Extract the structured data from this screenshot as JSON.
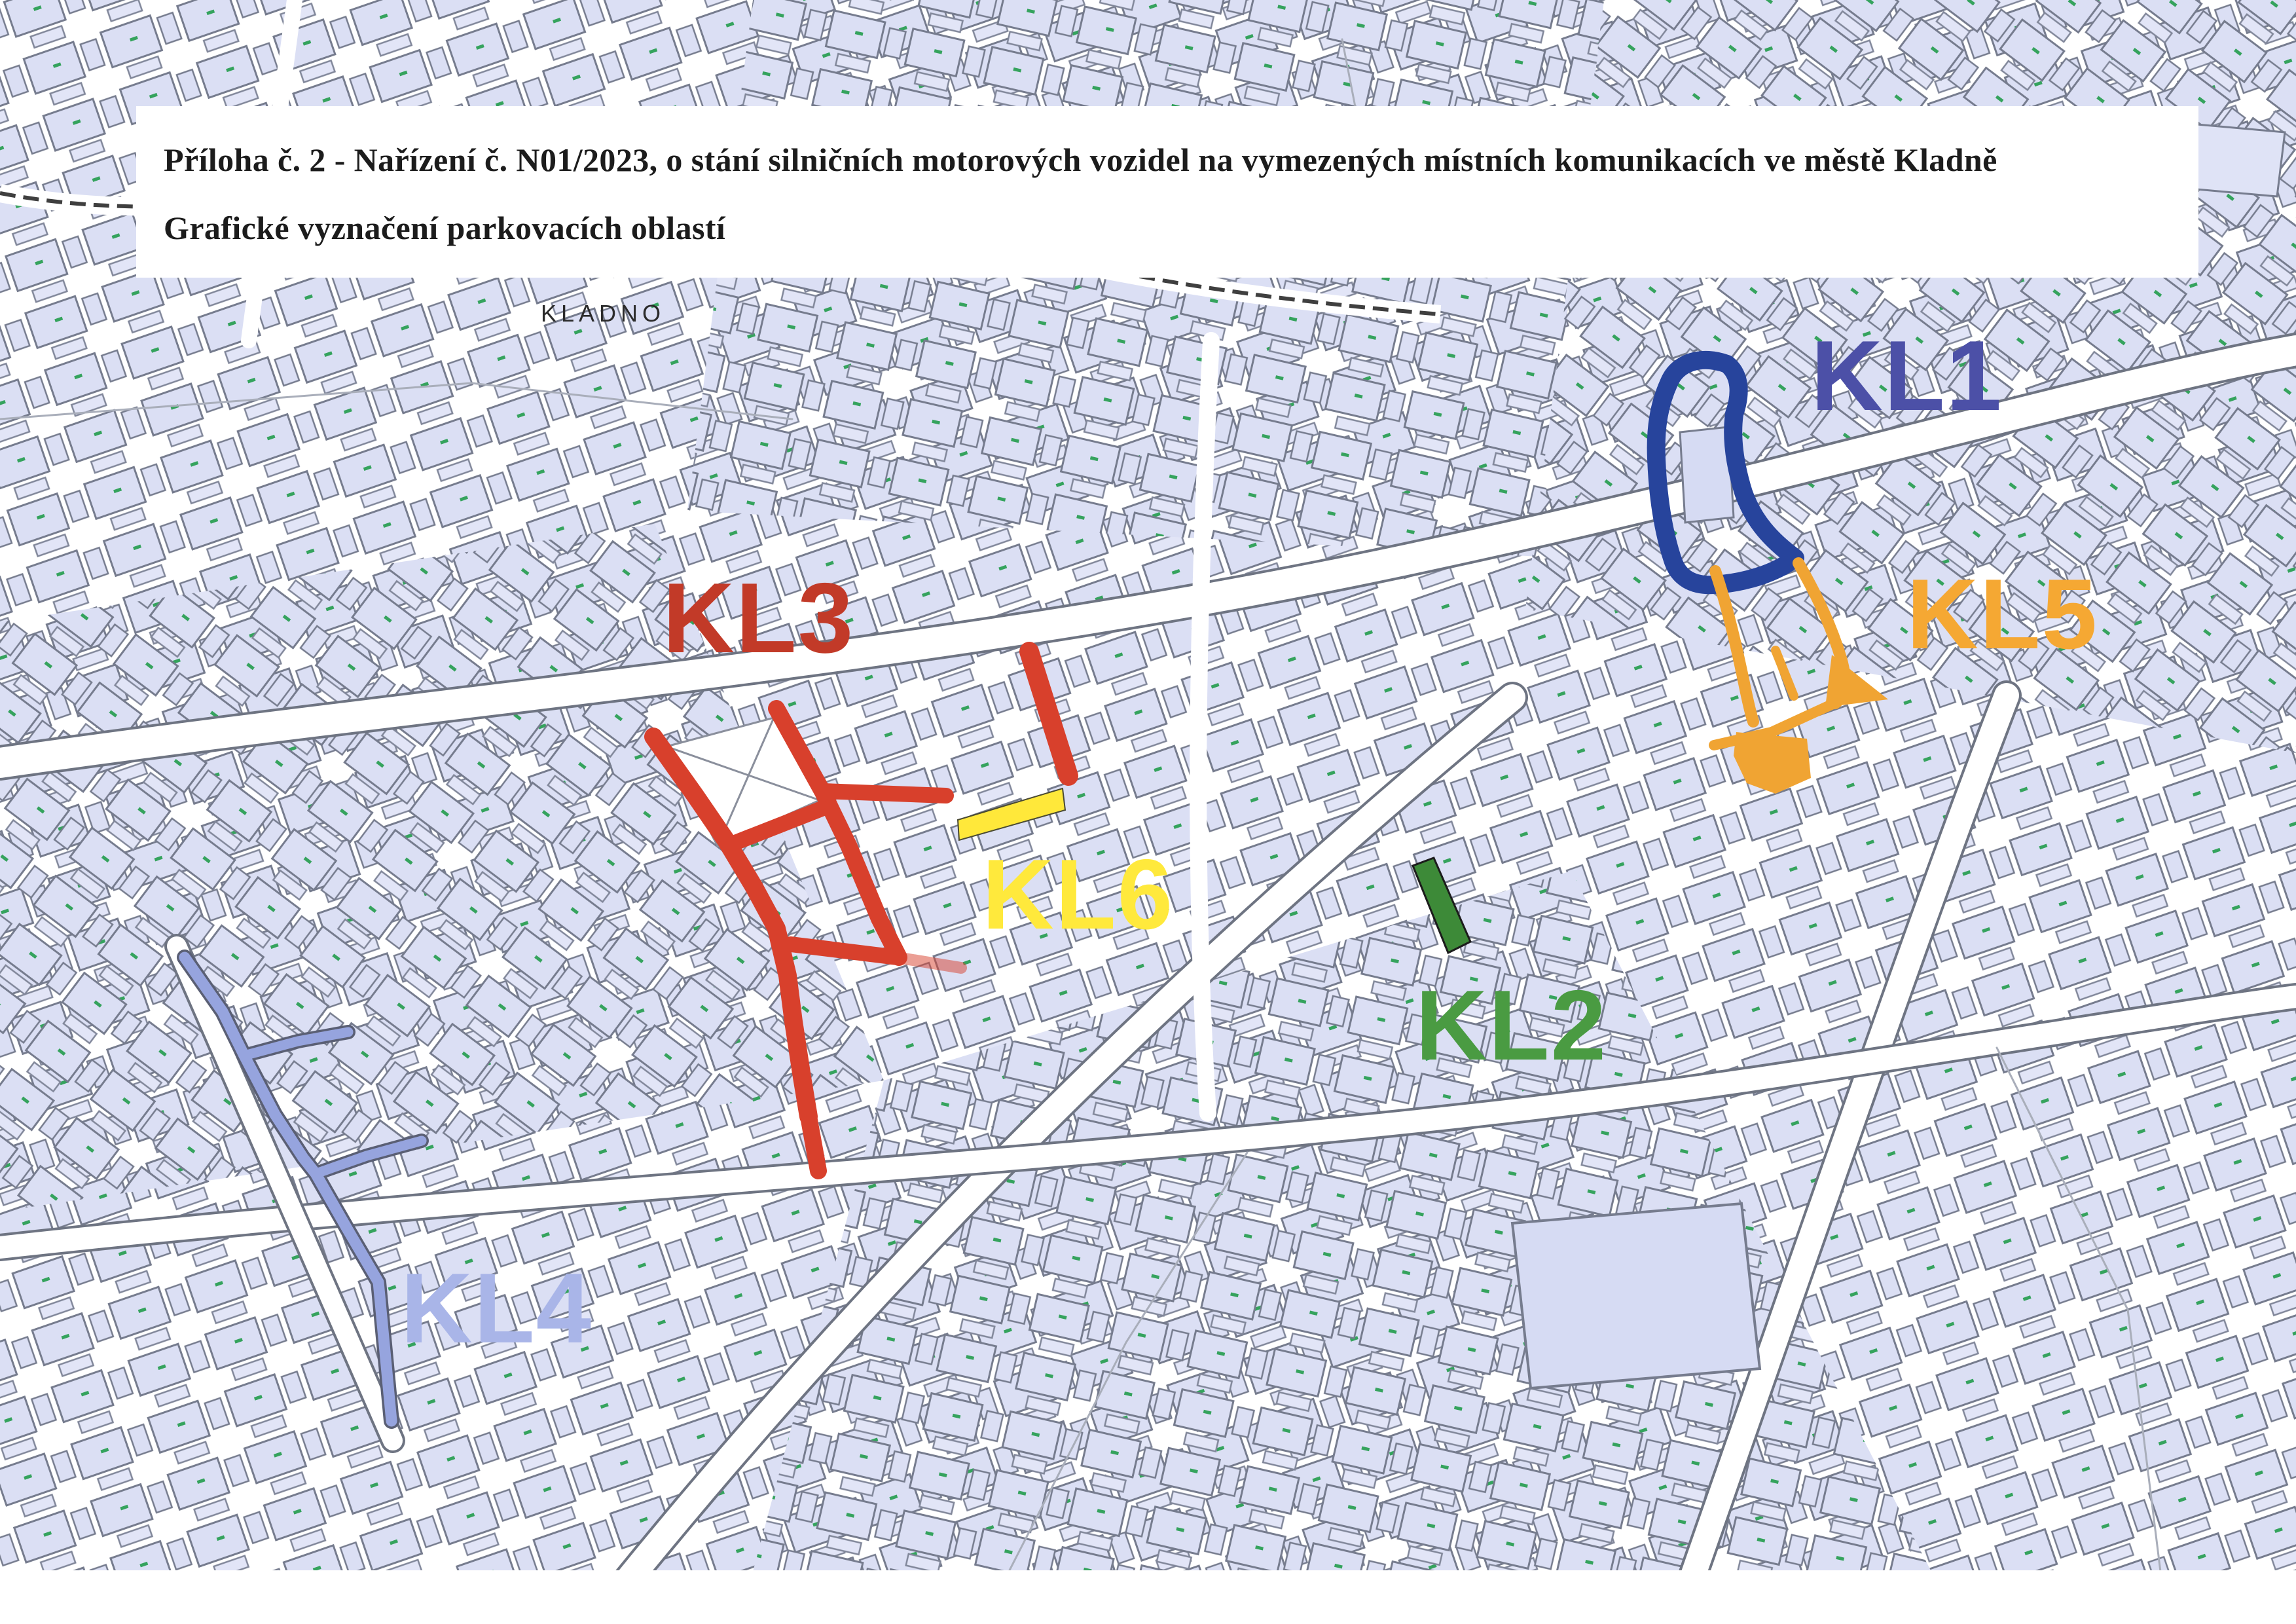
{
  "document": {
    "title_line1": "Příloha č. 2 -  Nařízení č. N01/2023, o stání silničních motorových vozidel na vymezených místních komunikacích ve městě Kladně",
    "title_line2": "Grafické vyznačení parkovacích oblastí"
  },
  "map": {
    "city_label": "KLADNO",
    "zones": [
      {
        "id": "KL1",
        "label": "KL1",
        "label_color": "#4C50A7",
        "marking_color": "#27449C"
      },
      {
        "id": "KL2",
        "label": "KL2",
        "label_color": "#4A9B42",
        "marking_color": "#3D8A38"
      },
      {
        "id": "KL3",
        "label": "KL3",
        "label_color": "#C23A28",
        "marking_color": "#D8402C"
      },
      {
        "id": "KL4",
        "label": "KL4",
        "label_color": "#A9B5E8",
        "marking_color": "#96A4DE"
      },
      {
        "id": "KL5",
        "label": "KL5",
        "label_color": "#F5A833",
        "marking_color": "#F0A433"
      },
      {
        "id": "KL6",
        "label": "KL6",
        "label_color": "#FFE93C",
        "marking_color": "#FFE83A"
      }
    ]
  }
}
